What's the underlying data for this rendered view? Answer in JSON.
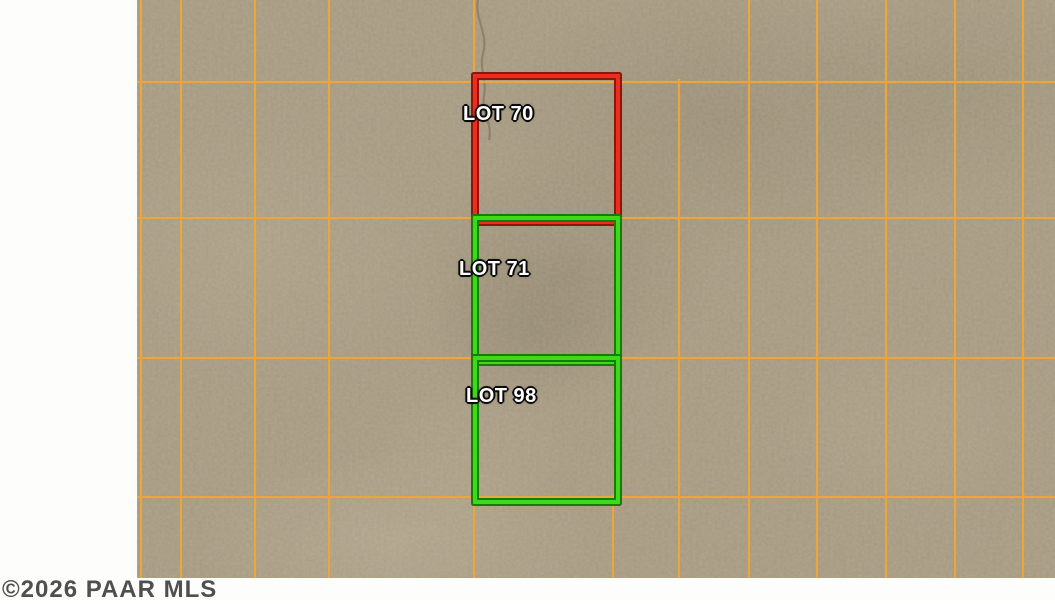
{
  "map": {
    "watermark": "©2026 PAAR MLS",
    "grid_color": "#f0a73a",
    "terrain_color": "#a89b82",
    "lots": [
      {
        "label": "LOT 70",
        "outline_color": "#ee2d1f",
        "outline_edge": "#8c150e"
      },
      {
        "label": "LOT 71",
        "outline_color": "#3cdb16",
        "outline_edge": "#187a08"
      },
      {
        "label": "LOT 98",
        "outline_color": "#3cdb16",
        "outline_edge": "#187a08"
      }
    ]
  }
}
